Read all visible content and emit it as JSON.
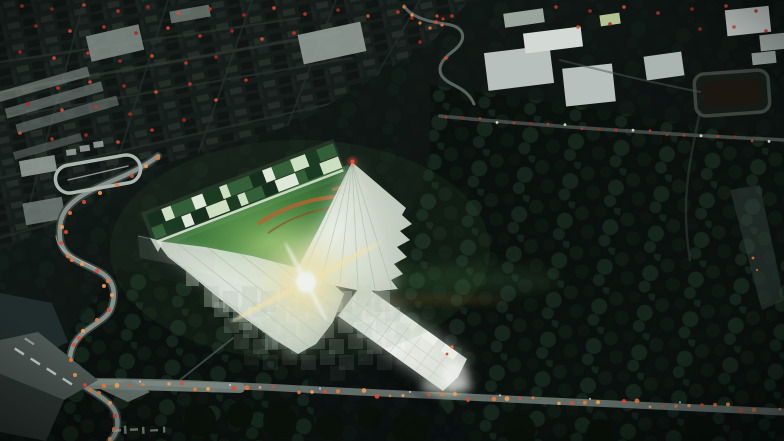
{
  "scene": {
    "aria_label": "Night-time aerial architectural rendering: a glowing white faceted canopy shaped like a three-armed arrow rises over an illuminated green sports field with an orange track arc, bordered by a band of lit green and white facade strips. Around the site lie dark city blocks dotted with red lights, pale warehouse roofs, dense tree canopies, and curving roads streaked with orange and red car lights.",
    "no_visible_text": true
  },
  "palette": {
    "bg_top": "#18221f",
    "bg_mid": "#0d1412",
    "bg_deep": "#05090b",
    "city_base": "#151d1a",
    "city_block_light": "#232c27",
    "city_block_dark": "#0e1513",
    "street_line": "#27312b",
    "warehouse_roof": "#b7c0bc",
    "warehouse_roof_bright": "#d3dad6",
    "tree_dark": "#0a100d",
    "tree_blob": "#16261c",
    "road_light": "#97a29d",
    "road_mid": "#6d7873",
    "road_dark": "#3b443f",
    "red_light": "#c23325",
    "red_light_dim": "#a8281c",
    "red_light_hot": "#dd4a30",
    "amber_light": "#e8793a",
    "amber_light_hot": "#f59b52",
    "white_light": "#d9e2dc",
    "field_bright": "#7fb35f",
    "field_mid": "#3f7a3c",
    "field_dark": "#173f22",
    "track_orange": "#c06030",
    "track_orange_dim": "#8f4a24",
    "band_dark": "#0f2418",
    "band_deep": "#16331f",
    "band_mid": "#2f5c36",
    "band_green": "#3e7a41",
    "band_lit": "#dcead0",
    "band_white": "#eef4ea",
    "canopy_core": "#ffffff",
    "canopy_light": "#eef1ea",
    "canopy_mid": "#dfe4dc",
    "canopy_shade": "#c6cec5",
    "flare_warm": "#ffedbb",
    "aviation_red": "#ff4434",
    "pond": "#202c2b",
    "vignette": "#020505"
  }
}
